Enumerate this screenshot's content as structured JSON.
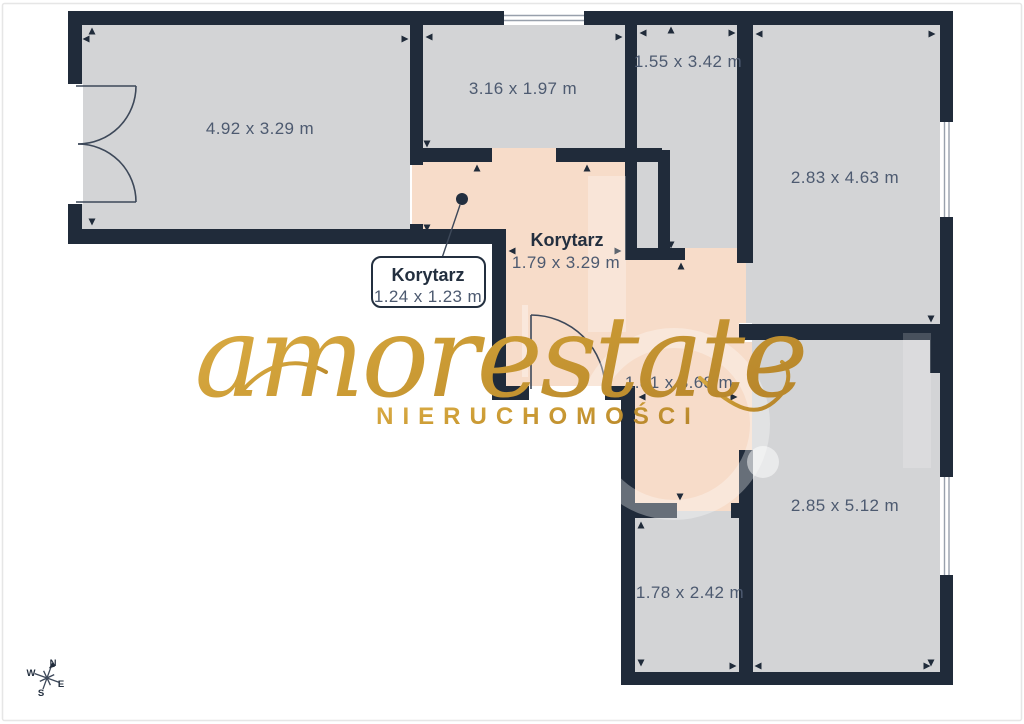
{
  "colors": {
    "wall": "#202b3a",
    "floor": "#d3d4d6",
    "corridor": "#f7dcc9",
    "text_dark": "#232f3f",
    "text_dim": "#4d5a70",
    "gold": "#d8a944",
    "gold_dark": "#b9882c",
    "window_line": "#98a0ac",
    "door_line": "#3d4859",
    "frame": "#e6e6e6"
  },
  "rooms": [
    {
      "label": "4.92 x 3.29 m"
    },
    {
      "label": "3.16 x 1.97 m"
    },
    {
      "label": "1.55 x 3.42 m"
    },
    {
      "label": "2.83 x 4.63 m"
    },
    {
      "label": "2.85 x 5.12 m"
    },
    {
      "label": "1.78 x 2.42 m"
    }
  ],
  "corridor": {
    "main_name": "Korytarz",
    "main_dims": "1.79 x 3.29 m",
    "lower_dims": "1.81 x 3.68 m",
    "callout_name": "Korytarz",
    "callout_dims": "1.24 x 1.23 m"
  },
  "watermark": {
    "brand": "amorestate",
    "subtitle": "NIERUCHOMOŚCI"
  },
  "compass": {
    "n": "N",
    "e": "E",
    "s": "S",
    "w": "W"
  }
}
